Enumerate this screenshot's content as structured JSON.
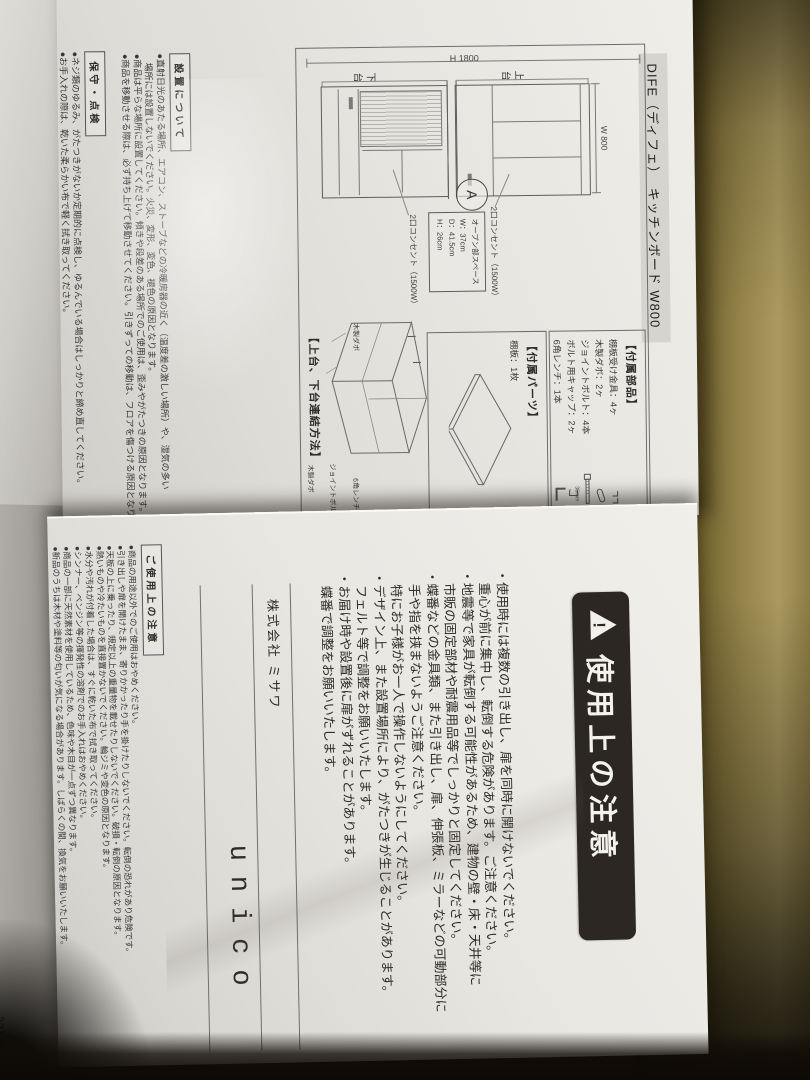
{
  "colors": {
    "metal_surface": "#8d7c45",
    "paper": "#e8e6e1",
    "title_band": "#d6d4cf",
    "banner_bg": "#2c2722",
    "banner_text": "#f4f2ee"
  },
  "sheet1": {
    "title": "DIFE（ディフェ）　キッチンボード W800",
    "elevation": {
      "height_dim": "H 1800",
      "width_dim": "W 800",
      "upper_unit": "上台",
      "lower_unit": "下台",
      "detail_marker": "A",
      "outlet_upper": "2口コンセント（1500W）",
      "outlet_lower": "2口コンセント（1500W）",
      "open_space_title": "オープン部スペース",
      "open_space_w": "W：37cm",
      "open_space_d": "D：41.5cm",
      "open_space_h": "H：26cm"
    },
    "parts": {
      "heading": "【付属部品】",
      "items": [
        "棚板受け金具：4ヶ",
        "木製ダボ：2ヶ",
        "ジョイントボルト：4本",
        "ボルト用キャップ：2ヶ",
        "6角レンチ：1本"
      ],
      "bolt_length": "35mm"
    },
    "accessory": {
      "heading": "【付属パーツ】",
      "item": "棚板：1枚"
    },
    "assembly": {
      "heading": "【上台、下台連結方法】",
      "label_dowel_top": "木製ダボ",
      "label_bolt": "ジョイントボルト",
      "label_wrench": "6角レンチ",
      "label_dowel_bottom": "木製ダボ"
    },
    "installation": {
      "heading": "設置について",
      "lines": [
        "●直射日光のあたる場所、エアコン、ストーブなどの冷暖房器の近く（温度差の激しい場所）や、湿気の多い",
        "　場所には設置しないでください。火災、変形、変色、褪色の原因となります。",
        "●商品は平らな場所に設置してください。傾きや段差のある場所でのご使用は、歪みやがたつきの原因となります。",
        "●商品を移動させる際は、必ず持ち上げて移動させてください。引きずっての移動は、フロアを傷つける原因となります。"
      ]
    },
    "maintenance": {
      "heading": "保守・点検",
      "lines": [
        "●ネジ類のゆるみ、がたつきがないか定期的に点検し、ゆるんでいる場合はしっかりと締め直してください。",
        "●お手入れの際は、乾いた柔らかい布で軽く拭き取ってください。"
      ]
    }
  },
  "sheet2": {
    "banner": "使用上の注意",
    "caution_lines": [
      "・使用時には複数の引き出し、扉を同時に開けないでください。",
      "　重心が前に集中し、転倒する危険があります。ご注意ください。",
      "・地震等で家具が転倒する可能性があるため、建物の壁・床・天井等に",
      "　市販の固定部材や耐震用品等でしっかりと固定してください。",
      "・蝶番などの金具類、また引き出し、扉、伸張板、ミラーなどの可動部分に",
      "　手や指を挟まないようご注意ください。",
      "　特にお子様がお一人で操作しないようにしてください。",
      "・デザイン上、また設置場所により、がたつきが生じることがあります。",
      "　フェルト等で調整をお願いいたします。",
      "・お届け時や設置後に扉がずれることがあります。",
      "　蝶番で調整をお願いいたします。"
    ],
    "company": "株式会社 ミサワ",
    "brand": "unico",
    "usage": {
      "heading": "ご使用上の注意",
      "lines": [
        "●商品の用途以外でのご使用はおやめください。",
        "●引き出しや扉を開けたまま、寄りかかったり手を掛けたりしないでください。転倒の恐れがあり危険です。",
        "●天板の上に乗ったり、規定以上の重量物を載せたりしないでください。破損・転倒の原因となります。",
        "●熱いものや冷たいものを直接置かないでください。輪ジミや変色の原因となります。",
        "●水分や汚れが付着した場合は、すぐに乾いた布で拭き取ってください。",
        "●シンナー、ベンジン等の揮発性の溶剤でのお手入れはおやめください。",
        "●商品の一部に天然素材を使用しているため、色味や木目が一点ずつ異なります。",
        "●新品のうちは木材や塗料等の匂いが気になる場合があります。しばらくの間、換気をお願いいたします。"
      ]
    }
  },
  "underlay": {
    "code": "221U05"
  }
}
